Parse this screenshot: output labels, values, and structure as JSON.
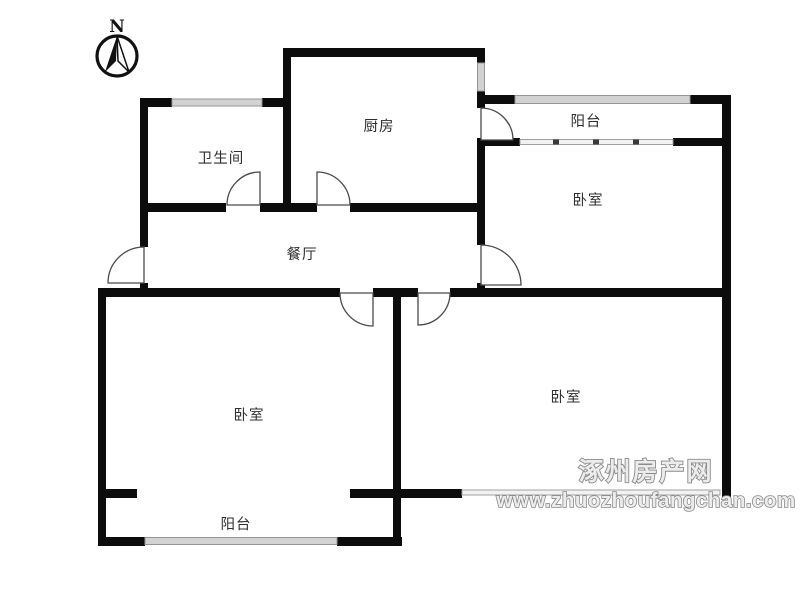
{
  "compass": {
    "north_label": "N"
  },
  "rooms": {
    "kitchen": {
      "label": "厨房"
    },
    "bathroom": {
      "label": "卫生间"
    },
    "balcony_top": {
      "label": "阳台"
    },
    "bedroom_top_right": {
      "label": "卧室"
    },
    "dining": {
      "label": "餐厅"
    },
    "bedroom_bottom_left": {
      "label": "卧室"
    },
    "balcony_bottom": {
      "label": "阳台"
    },
    "bedroom_bottom_right": {
      "label": "卧室"
    }
  },
  "watermark": {
    "site_name": "涿州房产网",
    "site_url": "www.zhuozhoufangchan.com"
  },
  "colors": {
    "wall": "#0c0c0c",
    "window_fill": "#d2d2d2",
    "window_border": "#969696",
    "label_text": "#2e2e2e",
    "watermark_gray": "#8a8a8a"
  }
}
